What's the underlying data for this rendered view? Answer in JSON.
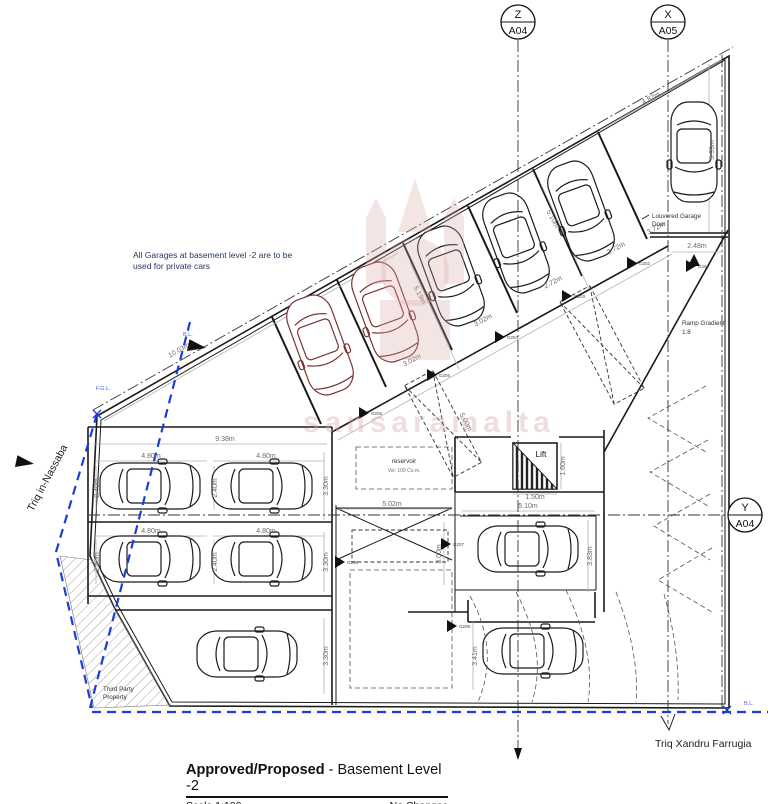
{
  "section_markers": {
    "z": {
      "letter": "Z",
      "sheet": "A04"
    },
    "x": {
      "letter": "X",
      "sheet": "A05"
    },
    "y": {
      "letter": "Y",
      "sheet": "A04"
    }
  },
  "streets": {
    "west": "Triq in-Nassaba",
    "south": "Triq Xandru Farrugia"
  },
  "notes": {
    "garage_note_line1": "All Garages at basement level -2 are to be",
    "garage_note_line2": "used for private cars",
    "third_party_line1": "Third Party",
    "third_party_line2": "Property",
    "louvered_line1": "Louvered Garage",
    "louvered_line2": "Door",
    "ramp_line1": "Ramp Gradient",
    "ramp_line2": "1:8"
  },
  "labels": {
    "lift": "Lift",
    "reservoir_title": "reservoir",
    "reservoir_volume": "Vol: 100 Cu.m."
  },
  "boundary_labels": {
    "fgl": "F.G.L.",
    "bl_top": "B.L.",
    "bl_corner": "B.L."
  },
  "watermark_text": "sansaramalta",
  "title_block": {
    "approved": "Approved/Proposed",
    "subtitle": " - Basement Level -2",
    "scale": "Scale 1:100",
    "changes": "No Changes"
  },
  "colors": {
    "boundary_blue": "#1a3fd4",
    "note_blue": "#1f3864",
    "maroon_car": "#7c3030",
    "watermark_pink": "#d9a8a8"
  },
  "dimensions": [
    {
      "text": "9.38m",
      "x": 225,
      "y": 441,
      "r": 0
    },
    {
      "text": "4.80m",
      "x": 151,
      "y": 458,
      "r": 0
    },
    {
      "text": "4.80m",
      "x": 266,
      "y": 458,
      "r": 0
    },
    {
      "text": "4.80m",
      "x": 151,
      "y": 533,
      "r": 0
    },
    {
      "text": "4.80m",
      "x": 266,
      "y": 533,
      "r": 0
    },
    {
      "text": "2.40m",
      "x": 99,
      "y": 488,
      "r": -90
    },
    {
      "text": "2.40m",
      "x": 217,
      "y": 488,
      "r": -90
    },
    {
      "text": "2.40m",
      "x": 99,
      "y": 562,
      "r": -90
    },
    {
      "text": "2.40m",
      "x": 217,
      "y": 562,
      "r": -90
    },
    {
      "text": "3.30m",
      "x": 328,
      "y": 486,
      "r": -90
    },
    {
      "text": "3.30m",
      "x": 328,
      "y": 562,
      "r": -90
    },
    {
      "text": "3.30m",
      "x": 328,
      "y": 656,
      "r": -90
    },
    {
      "text": "5.02m",
      "x": 392,
      "y": 506,
      "r": 0
    },
    {
      "text": "5.10m",
      "x": 528,
      "y": 508,
      "r": 0
    },
    {
      "text": "1.50m",
      "x": 535,
      "y": 499,
      "r": 0
    },
    {
      "text": "1.60m",
      "x": 565,
      "y": 466,
      "r": -90
    },
    {
      "text": "3.00m",
      "x": 441,
      "y": 554,
      "r": -90
    },
    {
      "text": "3.83m",
      "x": 592,
      "y": 556,
      "r": -90
    },
    {
      "text": "3.41m",
      "x": 477,
      "y": 656,
      "r": -90
    },
    {
      "text": "2.48m",
      "x": 697,
      "y": 248,
      "r": 0
    },
    {
      "text": "10.03m",
      "x": 180,
      "y": 352,
      "r": -30
    },
    {
      "text": "4.82m",
      "x": 652,
      "y": 100,
      "r": -28
    },
    {
      "text": "5.99m",
      "x": 714,
      "y": 150,
      "r": -90
    },
    {
      "text": "3.02m",
      "x": 413,
      "y": 362,
      "r": -28
    },
    {
      "text": "3.02m",
      "x": 484,
      "y": 322,
      "r": -28
    },
    {
      "text": "2.72m",
      "x": 617,
      "y": 250,
      "r": -28
    },
    {
      "text": "2.72m",
      "x": 554,
      "y": 284,
      "r": -28
    },
    {
      "text": "3.72m",
      "x": 657,
      "y": 230,
      "r": -28
    },
    {
      "text": "5.19m",
      "x": 418,
      "y": 296,
      "r": 62
    },
    {
      "text": "5.10m",
      "x": 551,
      "y": 220,
      "r": 62
    },
    {
      "text": "5.00m",
      "x": 464,
      "y": 423,
      "r": 62
    }
  ],
  "garages": [
    {
      "id": "G201",
      "x": 700,
      "y": 274
    },
    {
      "id": "G202",
      "x": 641,
      "y": 271
    },
    {
      "id": "G203",
      "x": 576,
      "y": 304
    },
    {
      "id": "G204",
      "x": 509,
      "y": 345
    },
    {
      "id": "G205",
      "x": 441,
      "y": 383
    },
    {
      "id": "G206",
      "x": 373,
      "y": 421
    },
    {
      "id": "G207",
      "x": 455,
      "y": 552
    },
    {
      "id": "G208",
      "x": 349,
      "y": 570
    },
    {
      "id": "G209",
      "x": 461,
      "y": 634
    }
  ]
}
